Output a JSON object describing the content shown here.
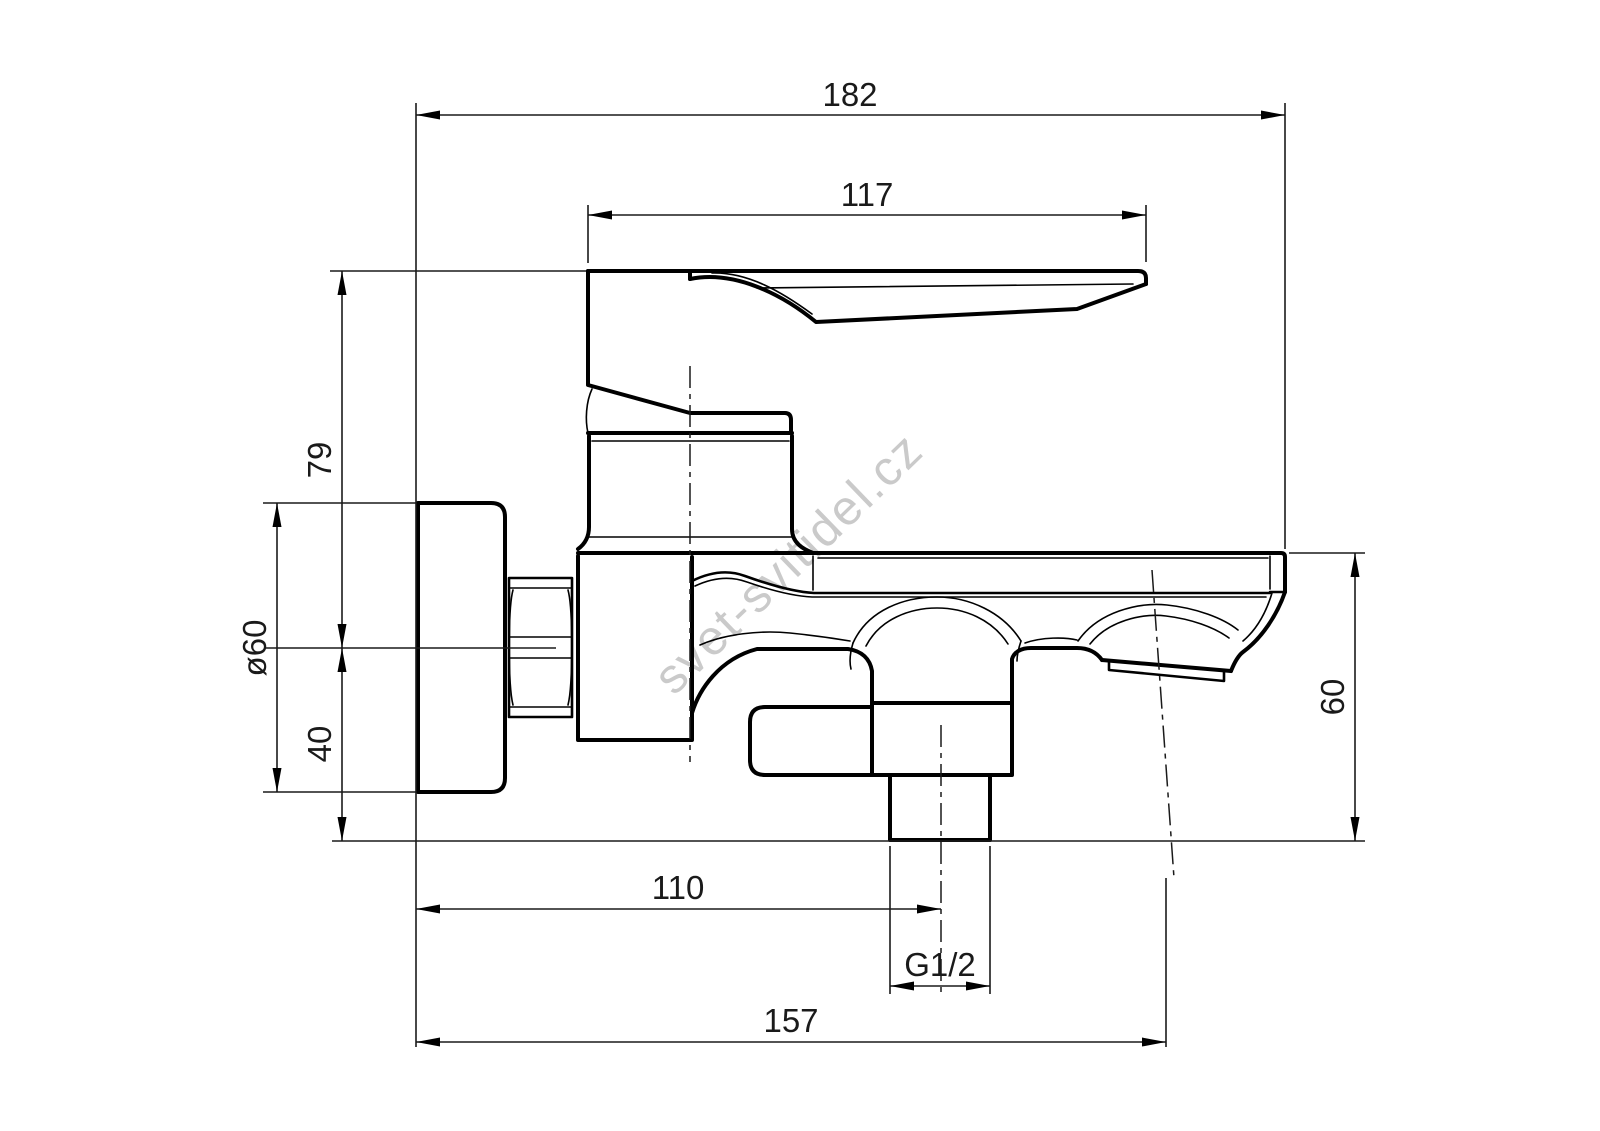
{
  "meta": {
    "background_color": "#ffffff",
    "line_color": "#000000",
    "drawing_type": "technical dimension drawing - wall-mounted bath mixer tap, side view"
  },
  "watermark": {
    "text": "svet-svitidel.cz",
    "color": "#c8c8c8"
  },
  "dims": {
    "overall_depth": "182",
    "lever_length": "117",
    "lever_top_to_axis": "79",
    "flange_diameter": "ø60",
    "axis_to_flange_bottom": "40",
    "spout_drop": "60",
    "wall_to_shower_outlet": "110",
    "outlet_thread": "G1/2",
    "wall_to_spout_tip": "157"
  }
}
